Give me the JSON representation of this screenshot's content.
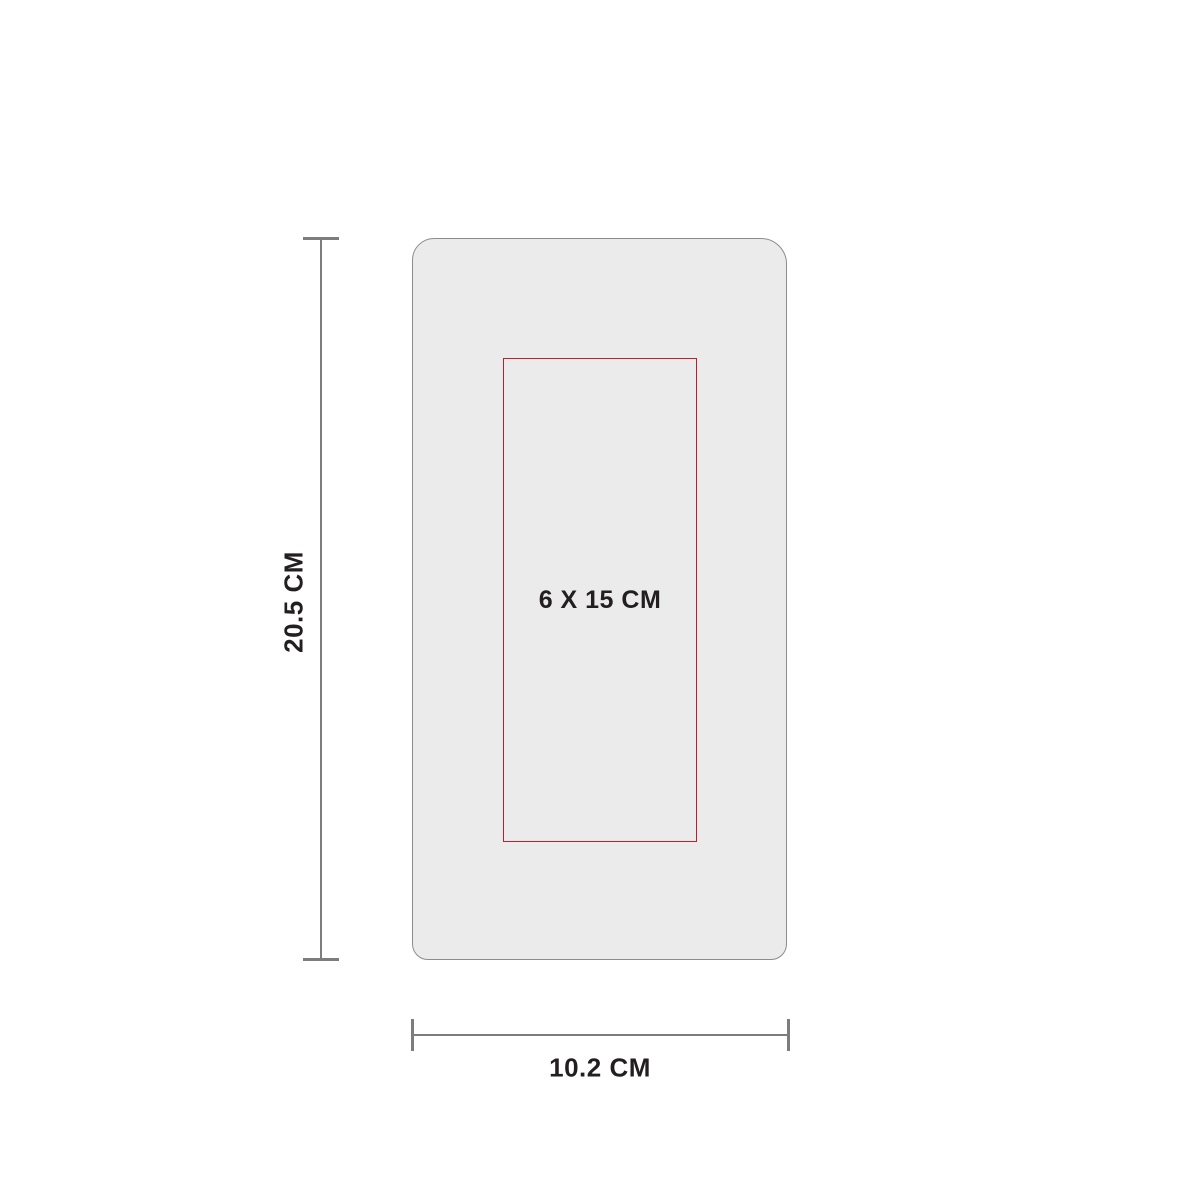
{
  "diagram": {
    "type": "product-imprint-dimension-diagram",
    "product": {
      "fill_color": "#ebebeb",
      "stroke_color": "#8c8c8c"
    },
    "print_area": {
      "label": "6 X 15 CM",
      "stroke_color": "#be1e2d"
    },
    "height_dimension": {
      "label": "20.5 CM"
    },
    "width_dimension": {
      "label": "10.2 CM"
    },
    "dimension_line_color": "#7d7d7d",
    "text_color": "#231f20",
    "background_color": "#ffffff"
  }
}
